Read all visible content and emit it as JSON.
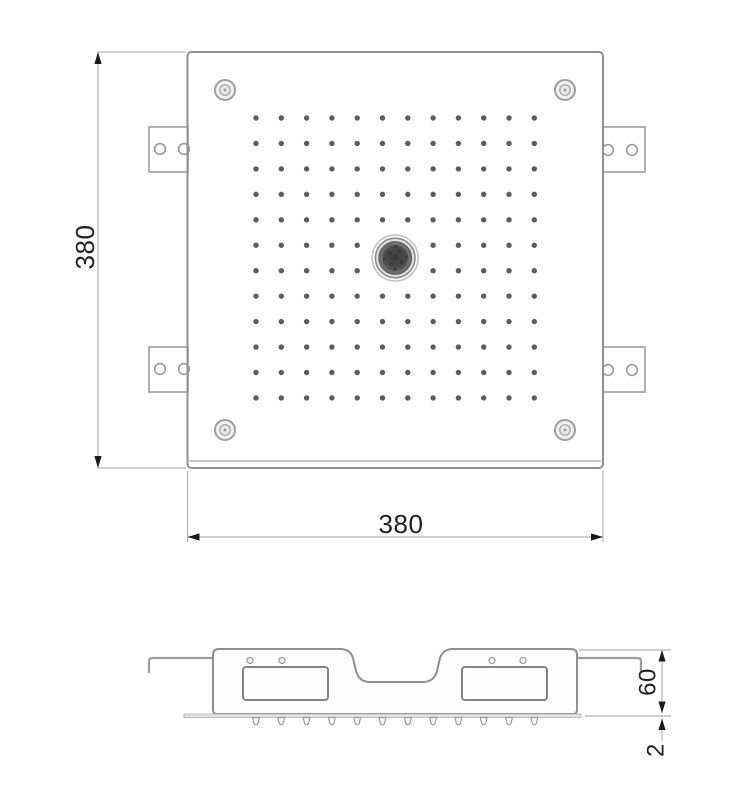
{
  "page": {
    "background": "#ffffff"
  },
  "drawing": {
    "type": "technical-drawing",
    "dimensions": {
      "plan_height": {
        "value": "380"
      },
      "plan_width": {
        "value": "380"
      },
      "section_height": {
        "value": "60"
      },
      "panel_thickness": {
        "value": "2"
      }
    },
    "colors": {
      "outline": "#8f8f8f",
      "bracket": "#9c9c9c",
      "thin_line": "#aaaaaa",
      "dim_line": "#b3b3b3",
      "arrow": "#1a1a1a",
      "text": "#212121",
      "dot": "#5c5c5c",
      "knob_ring": "#8d8d8d",
      "knob_dark": "#474747"
    },
    "nozzle_grid": {
      "rows": 12,
      "cols": 12,
      "x_start": 256,
      "y_start": 118,
      "x_step": 25.3,
      "y_step": 25.45,
      "dot_radius": 2.7,
      "center_x": 395.2,
      "center_y": 258,
      "center_clear_radius": 26
    },
    "side_nozzles": {
      "count": 12,
      "x_start": 256,
      "x_step": 25.3,
      "y_top": 717.5
    }
  }
}
